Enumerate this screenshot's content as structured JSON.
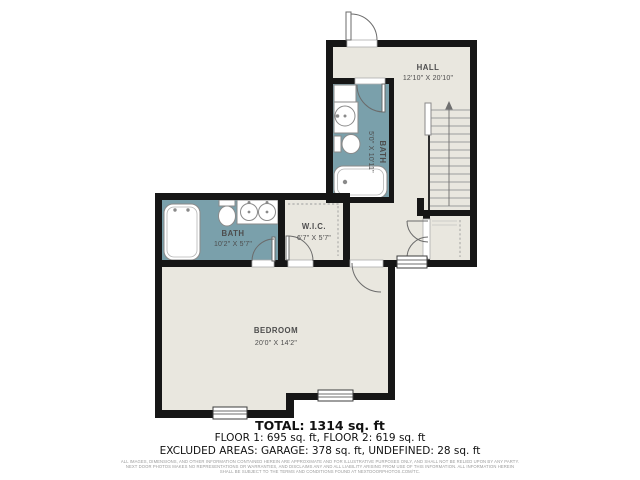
{
  "plan": {
    "rooms": {
      "hall": {
        "name": "HALL",
        "dims": "12'10\" X 20'10\""
      },
      "bath_upper": {
        "name": "BATH",
        "dims": "5'0\" X 10'11\""
      },
      "bath_lower": {
        "name": "BATH",
        "dims": "10'2\" X 5'7\""
      },
      "wic": {
        "name": "W.I.C.",
        "dims": "6'7\" X 5'7\""
      },
      "bedroom": {
        "name": "BEDROOM",
        "dims": "20'0\" X 14'2\""
      }
    }
  },
  "summary": {
    "total": "TOTAL: 1314 sq. ft",
    "floors": "FLOOR 1: 695 sq. ft, FLOOR 2: 619 sq. ft",
    "excluded": "EXCLUDED AREAS: GARAGE: 378 sq. ft, UNDEFINED: 28 sq. ft"
  },
  "disclaimer": {
    "line1": "ALL IMAGES, DIMENSIONS, AND OTHER INFORMATION CONTAINED HEREIN ARE APPROXIMATE AND FOR ILLUSTRATIVE PURPOSES ONLY, AND SHALL NOT BE RELIED UPON BY ANY PARTY.",
    "line2": "NEXT DOOR PHOTOS MAKES NO REPRESENTATIONS OR WARRANTIES, AND DISCLAIMS ANY AND ALL LIABILITY ARISING FROM USE OF THIS INFORMATION. ALL INFORMATION HEREIN",
    "line3": "SHALL BE SUBJECT TO THE TERMS AND CONDITIONS FOUND AT NEXTDOORPHOTOS.COM/TC."
  },
  "colors": {
    "wall": "#161616",
    "room_fill": "#e9e7df",
    "bath_fill": "#7aa0ab",
    "text": "#4d4d4d",
    "fixture_stroke": "#8a8a8a",
    "summary_text": "#111111",
    "disclaimer_text": "#9a9a9a"
  }
}
